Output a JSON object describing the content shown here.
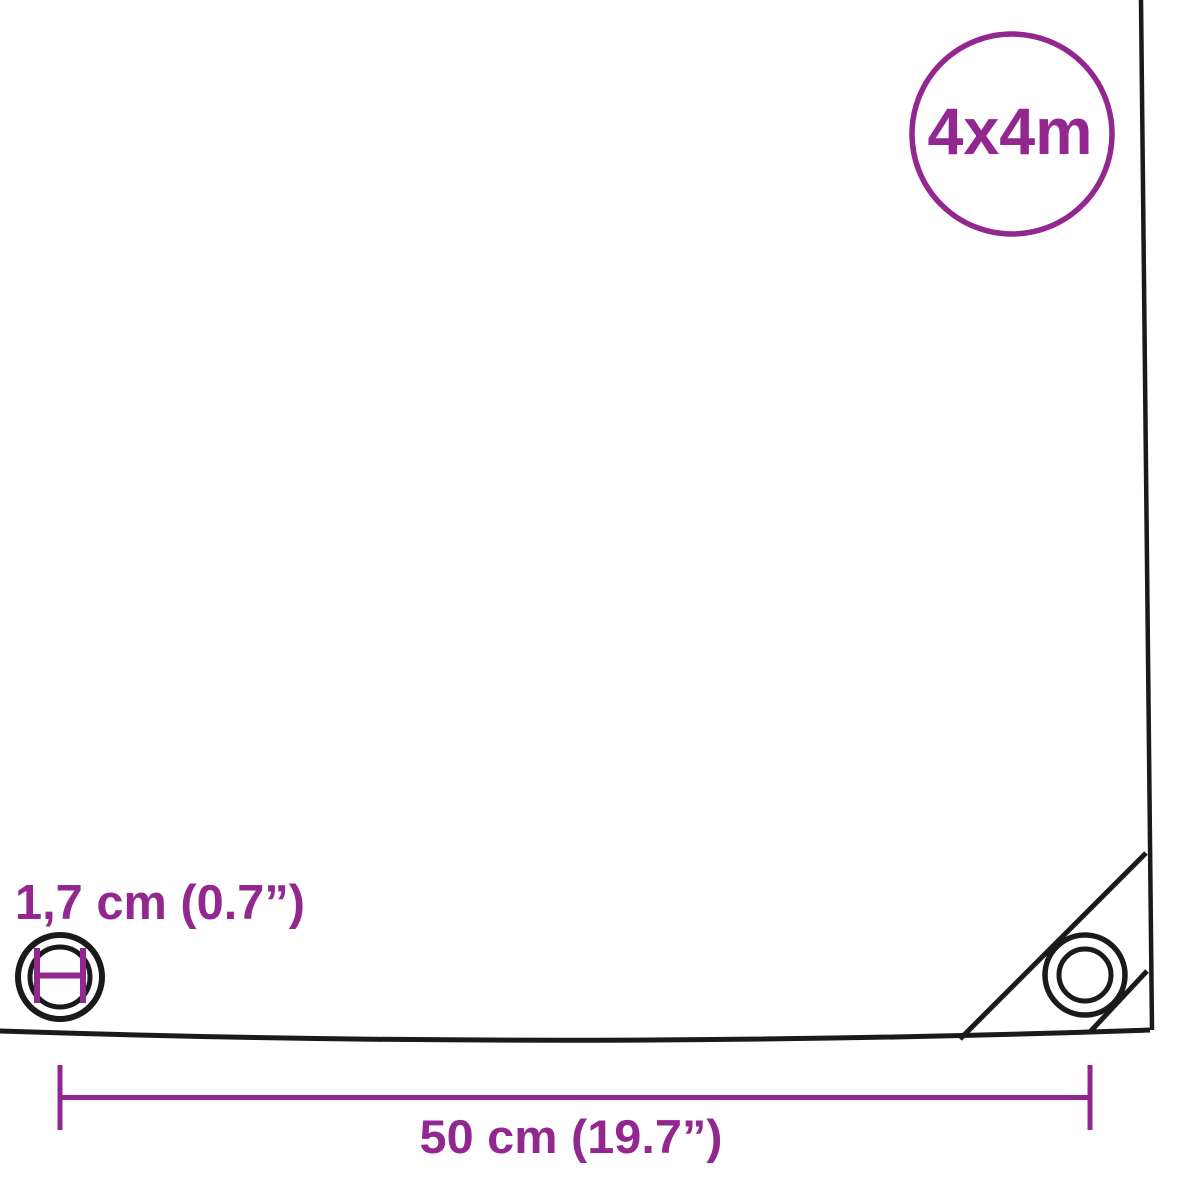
{
  "diagram": {
    "type": "product-dimension-diagram",
    "subject": "tarpaulin corner with grommets",
    "badge": {
      "label": "4x4m"
    },
    "labels": {
      "grommet_diameter": "1,7 cm (0.7”)",
      "grommet_spacing": "50 cm (19.7”)"
    },
    "colors": {
      "accent_purple": "#92278F",
      "outline_black": "#1a1a1a",
      "background": "#FFFFFF"
    },
    "icons": [
      {
        "name": "size-badge-circle",
        "shape": "circle-outline"
      },
      {
        "name": "grommet-diameter-icon",
        "shape": "concentric-circles-with-diameter-marker"
      },
      {
        "name": "corner-grommet-icon",
        "shape": "concentric-circles"
      }
    ]
  }
}
